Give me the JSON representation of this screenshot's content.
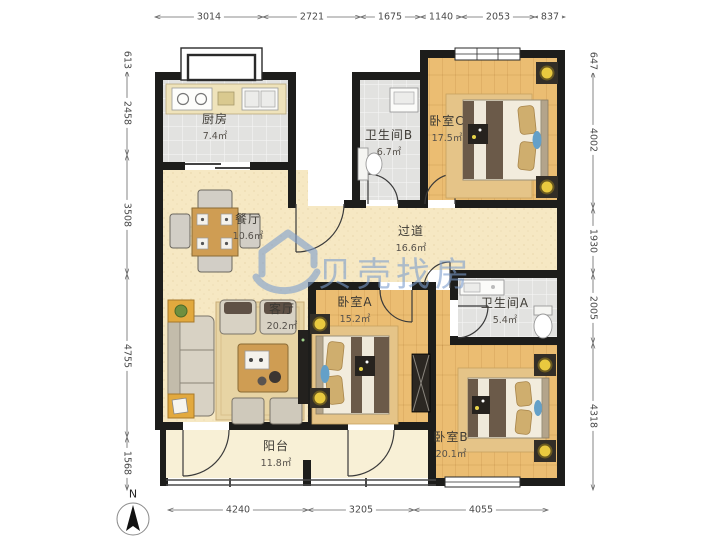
{
  "watermark": {
    "text": "贝壳找房"
  },
  "compass": {
    "label": "N"
  },
  "dims": {
    "top": [
      "3014",
      "2721",
      "1675",
      "1140",
      "2053",
      "837"
    ],
    "bottom": [
      "4240",
      "3205",
      "4055"
    ],
    "left": [
      "613",
      "2458",
      "3508",
      "4755",
      "1568"
    ],
    "right": [
      "647",
      "4002",
      "1930",
      "2005",
      "4318"
    ]
  },
  "rooms": {
    "kitchen": {
      "name": "厨房",
      "area": "7.4㎡"
    },
    "dining": {
      "name": "餐厅",
      "area": "10.6㎡"
    },
    "bath_b": {
      "name": "卫生间B",
      "area": "6.7㎡"
    },
    "bedroom_c": {
      "name": "卧室C",
      "area": "17.5㎡"
    },
    "hallway": {
      "name": "过道",
      "area": "16.6㎡"
    },
    "living": {
      "name": "客厅",
      "area": "20.2㎡"
    },
    "bedroom_a": {
      "name": "卧室A",
      "area": "15.2㎡"
    },
    "bath_a": {
      "name": "卫生间A",
      "area": "5.4㎡"
    },
    "bedroom_b": {
      "name": "卧室B",
      "area": "20.1㎡"
    },
    "balcony": {
      "name": "阳台",
      "area": "11.8㎡"
    }
  },
  "colors": {
    "wall": "#1d1d1b",
    "floor_beige": "#f6e8c3",
    "floor_wood": "#ebbd72",
    "floor_tile": "#e2e2e0",
    "floor_balcony": "#f8f0d6",
    "rug": "#e5c488",
    "watermark_blue": "#7c9dcd",
    "lamp_yellow": "#e9c93f"
  }
}
